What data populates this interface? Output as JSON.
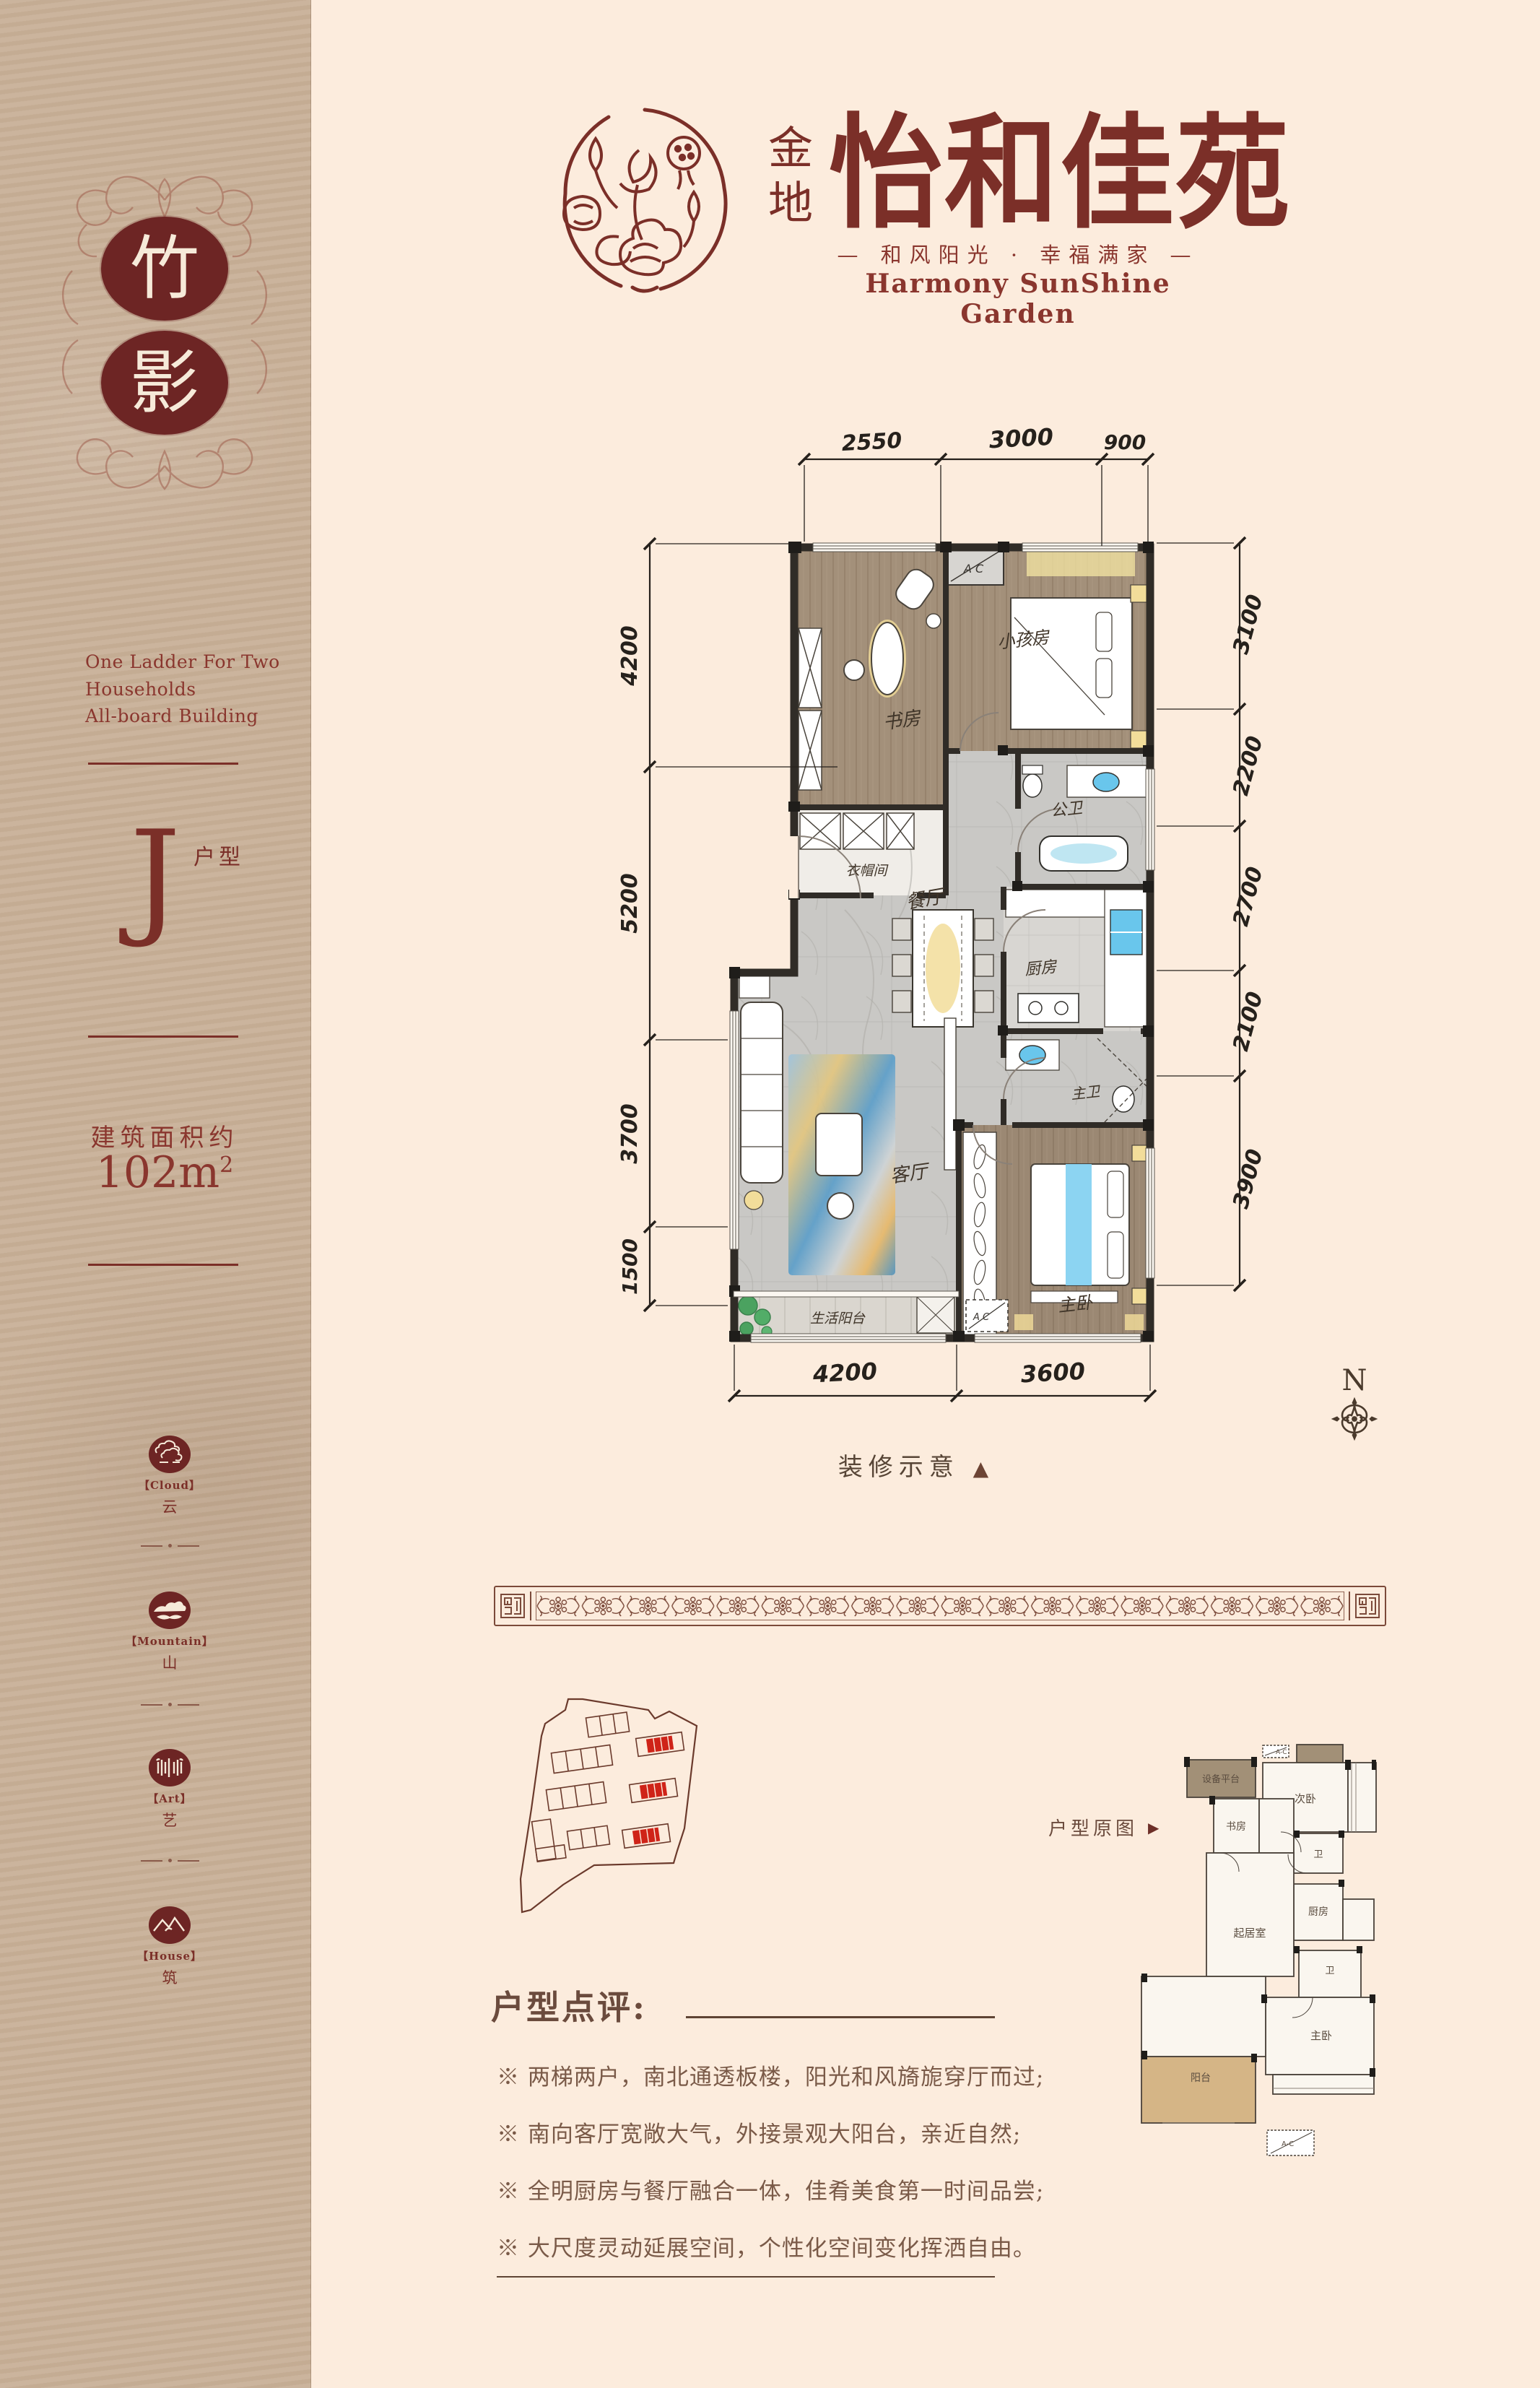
{
  "sidebar": {
    "series": [
      "竹",
      "影"
    ],
    "tagline": [
      "One Ladder For Two",
      "Households",
      "All-board Building"
    ],
    "unit": {
      "letter": "J",
      "suffix": "户型"
    },
    "area": {
      "label": "建筑面积约",
      "value": "102m",
      "sup": "2"
    },
    "badges": [
      {
        "en": "【Cloud】",
        "zh": "云"
      },
      {
        "en": "【Mountain】",
        "zh": "山"
      },
      {
        "en": "【Art】",
        "zh": "艺"
      },
      {
        "en": "【House】",
        "zh": "筑"
      }
    ]
  },
  "header": {
    "brand_cn_prefix": "金地",
    "brand_cn": "怡和佳苑",
    "slogan": "— 和风阳光 · 幸福满家 —",
    "brand_en": "Harmony SunShine Garden"
  },
  "floorplan": {
    "dims_top": [
      "2550",
      "3000",
      "900"
    ],
    "dims_left": [
      "4200",
      "5200",
      "3700",
      "1500"
    ],
    "dims_right": [
      "3100",
      "2200",
      "2700",
      "2100",
      "3900"
    ],
    "dims_bottom": [
      "4200",
      "3600"
    ],
    "rooms": {
      "study": "书房",
      "kids": "小孩房",
      "guest_bath": "公卫",
      "cloak": "衣帽间",
      "dining": "餐厅",
      "kitchen": "厨房",
      "master_bath": "主卫",
      "living": "客厅",
      "master": "主卧",
      "balcony": "生活阳台",
      "ac": "A C"
    },
    "caption": "装修示意",
    "caption_marker": "▲",
    "compass": "N"
  },
  "review": {
    "title": "户型点评:",
    "points": [
      "※ 两梯两户，南北通透板楼，阳光和风旖旎穿厅而过;",
      "※ 南向客厅宽敞大气，外接景观大阳台，亲近自然;",
      "※ 全明厨房与餐厅融合一体，佳肴美食第一时间品尝;",
      "※ 大尺度灵动延展空间，个性化空间变化挥洒自由。"
    ]
  },
  "original_plan": {
    "label": "户型原图",
    "marker": "▶",
    "rooms": {
      "equipment": "设备平台",
      "second": "次卧",
      "study": "书房",
      "bath1": "卫",
      "kitchen": "厨房",
      "living": "起居室",
      "bath2": "卫",
      "master": "主卧",
      "balcony": "阳台",
      "ac": "A-C"
    }
  },
  "colors": {
    "maroon": "#7b2f28",
    "deep_maroon": "#6d2524",
    "brown_text": "#6b4b3d",
    "band_brown": "#7b4a3a",
    "site_red": "#cf2318",
    "cream": "#fcecdd",
    "kraft": "#c8b098"
  }
}
